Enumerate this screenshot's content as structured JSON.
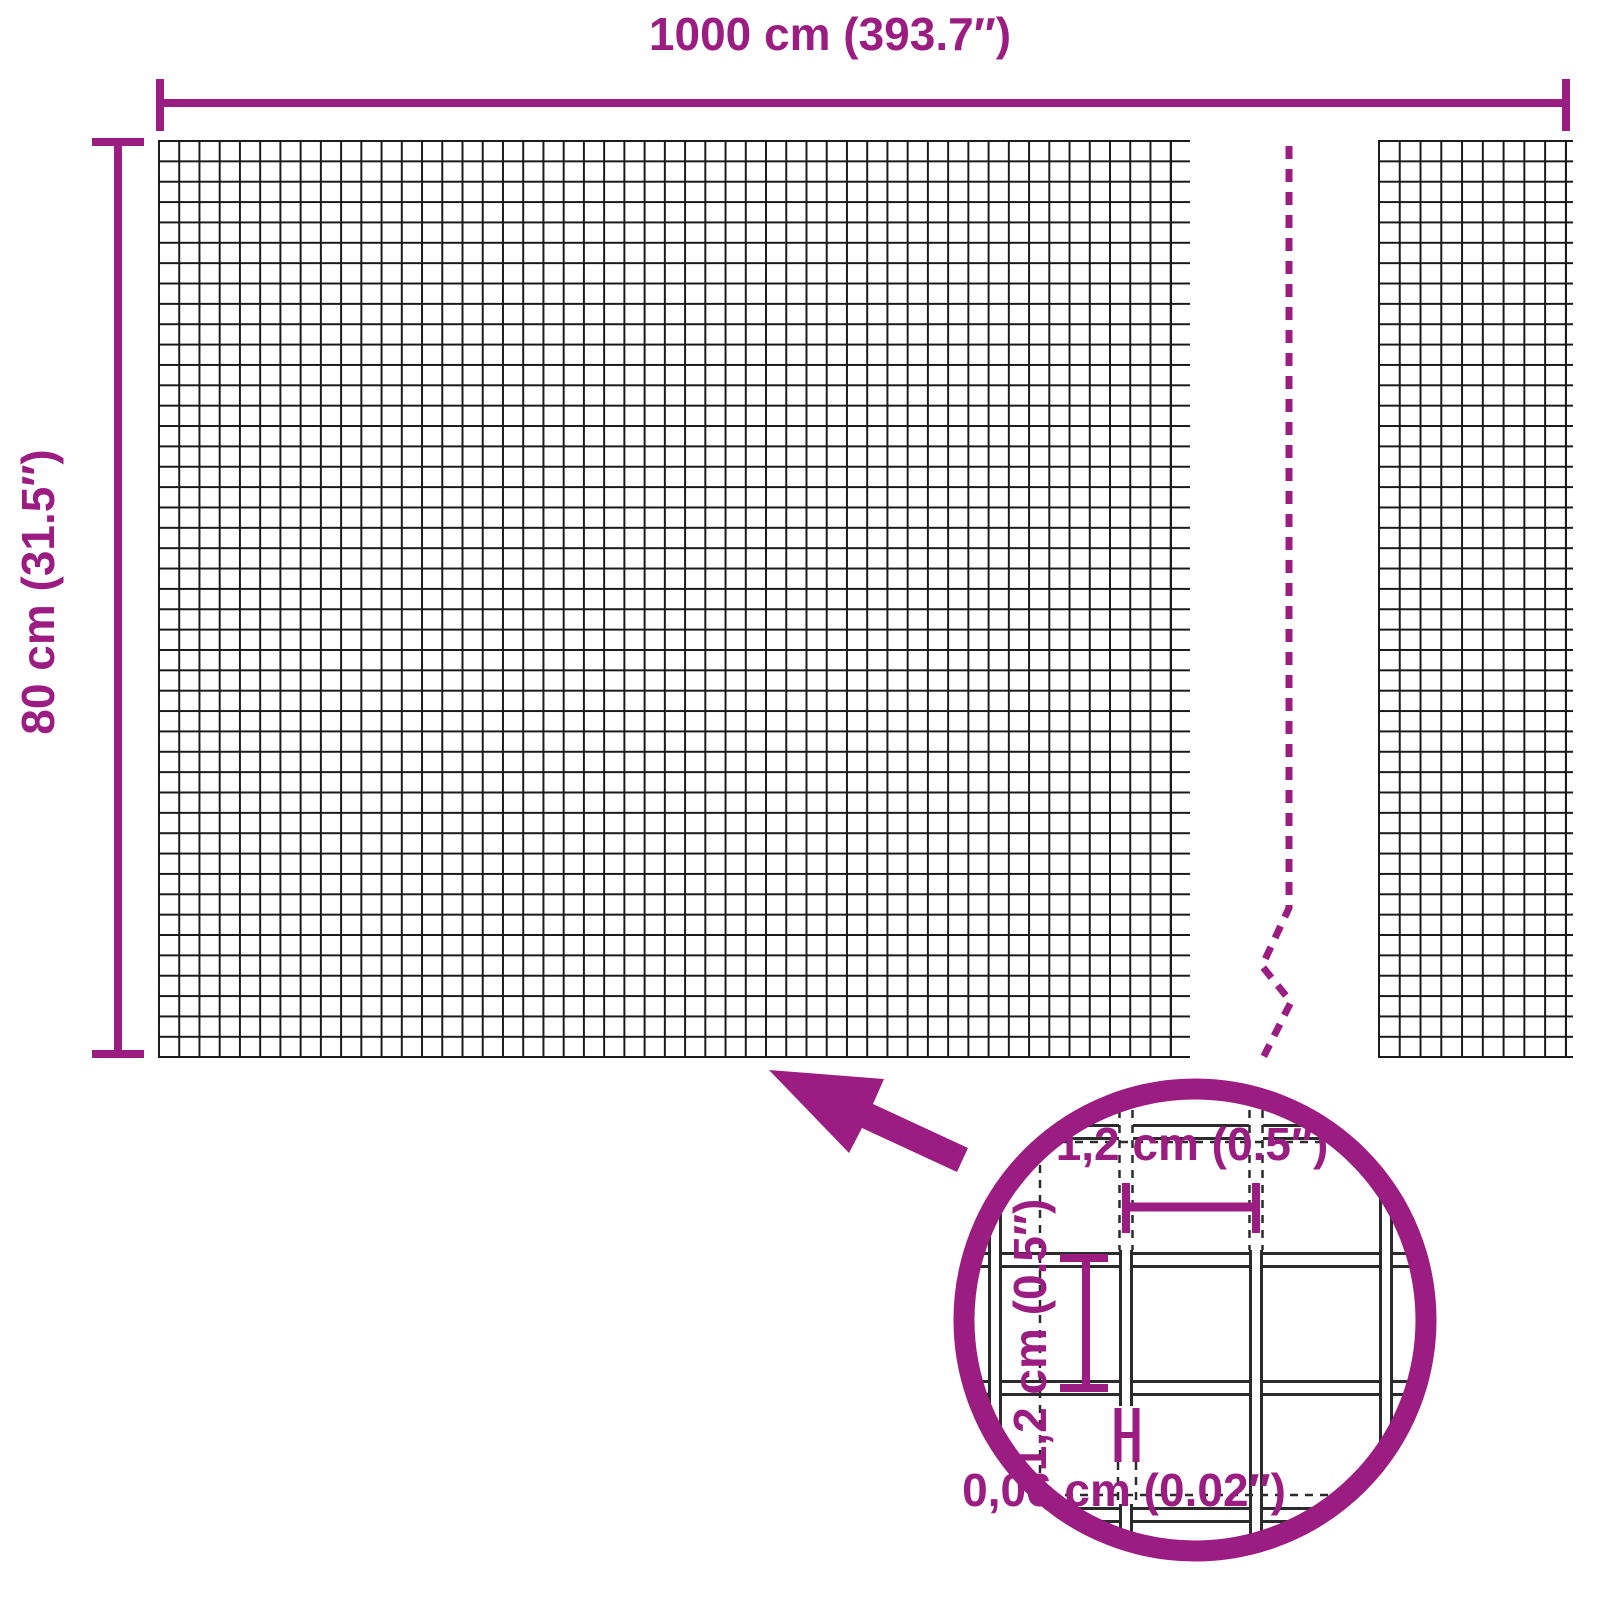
{
  "diagram": {
    "overall_width_label": "1000 cm (393.7″)",
    "overall_height_label": "80 cm (31.5″)",
    "mesh_width_label": "1,2 cm (0.5″)",
    "mesh_height_label": "1,2 cm (0.5″)",
    "wire_thickness_label": "0,06 cm (0.02″)",
    "colors": {
      "accent": "#9B1D82",
      "wire": "#2b2b2b",
      "mesh": "#1a1a1a",
      "background": "#ffffff"
    }
  }
}
